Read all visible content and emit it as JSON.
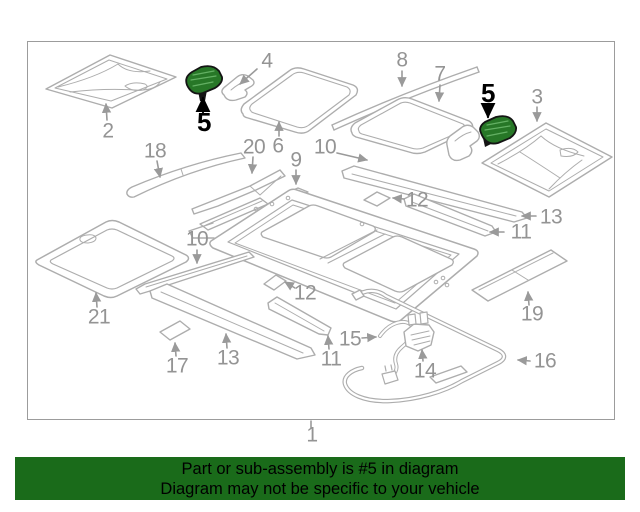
{
  "banner": {
    "line1": "Part or sub-assembly is #5 in diagram",
    "line2": "Diagram may not be specific to your vehicle",
    "bg_color": "#1a6b1a",
    "text_color": "#000000"
  },
  "diagram": {
    "border_color": "#9c9c9c",
    "line_color": "#adadad",
    "label_color": "#949494",
    "arrow_color": "#9a9a9a",
    "highlight_fill": "#277727",
    "highlight_rib_color": "#63b063",
    "highlight_outline": "#141414",
    "highlight_label_color": "#000000",
    "highlighted_part_number": "5",
    "callouts": [
      {
        "id": "2",
        "label": "2",
        "x": 108,
        "y": 131,
        "highlighted": false,
        "arrow": {
          "x1": 107,
          "y1": 120,
          "x2": 106,
          "y2": 104
        }
      },
      {
        "id": "5-left",
        "label": "5",
        "x": 204,
        "y": 122,
        "highlighted": true,
        "arrow": {
          "x1": 203,
          "y1": 112,
          "x2": 203,
          "y2": 98
        }
      },
      {
        "id": "4-left",
        "label": "4",
        "x": 267,
        "y": 61,
        "highlighted": false,
        "arrow": {
          "x1": 257,
          "y1": 69,
          "x2": 240,
          "y2": 84
        }
      },
      {
        "id": "6",
        "label": "6",
        "x": 278,
        "y": 146,
        "highlighted": false,
        "arrow": {
          "x1": 279,
          "y1": 136,
          "x2": 279,
          "y2": 122
        }
      },
      {
        "id": "8",
        "label": "8",
        "x": 402,
        "y": 60,
        "highlighted": false,
        "arrow": {
          "x1": 402,
          "y1": 71,
          "x2": 402,
          "y2": 86
        }
      },
      {
        "id": "7",
        "label": "7",
        "x": 440,
        "y": 74,
        "highlighted": false,
        "arrow": {
          "x1": 440,
          "y1": 85,
          "x2": 439,
          "y2": 101
        }
      },
      {
        "id": "5-right",
        "label": "5",
        "x": 488,
        "y": 93,
        "highlighted": true,
        "arrow": {
          "x1": 488,
          "y1": 104,
          "x2": 488,
          "y2": 117
        }
      },
      {
        "id": "3",
        "label": "3",
        "x": 537,
        "y": 97,
        "highlighted": false,
        "arrow": {
          "x1": 537,
          "y1": 107,
          "x2": 537,
          "y2": 121
        }
      },
      {
        "id": "18",
        "label": "18",
        "x": 155,
        "y": 151,
        "highlighted": false,
        "arrow": {
          "x1": 157,
          "y1": 161,
          "x2": 160,
          "y2": 177
        }
      },
      {
        "id": "20",
        "label": "20",
        "x": 254,
        "y": 147,
        "highlighted": false,
        "arrow": {
          "x1": 253,
          "y1": 157,
          "x2": 252,
          "y2": 173
        }
      },
      {
        "id": "9",
        "label": "9",
        "x": 296,
        "y": 160,
        "highlighted": false,
        "arrow": {
          "x1": 296,
          "y1": 170,
          "x2": 296,
          "y2": 184
        }
      },
      {
        "id": "10-top",
        "label": "10",
        "x": 325,
        "y": 147,
        "highlighted": false,
        "arrow": {
          "x1": 337,
          "y1": 153,
          "x2": 367,
          "y2": 160
        }
      },
      {
        "id": "12-right",
        "label": "12",
        "x": 417,
        "y": 200,
        "highlighted": false,
        "arrow": {
          "x1": 404,
          "y1": 199,
          "x2": 393,
          "y2": 198
        }
      },
      {
        "id": "13-right",
        "label": "13",
        "x": 551,
        "y": 217,
        "highlighted": false,
        "arrow": {
          "x1": 536,
          "y1": 216,
          "x2": 522,
          "y2": 216
        }
      },
      {
        "id": "11-right",
        "label": "11",
        "x": 521,
        "y": 232,
        "highlighted": false,
        "arrow": {
          "x1": 504,
          "y1": 232,
          "x2": 490,
          "y2": 232
        }
      },
      {
        "id": "10-left",
        "label": "10",
        "x": 197,
        "y": 239,
        "highlighted": false,
        "arrow": {
          "x1": 197,
          "y1": 250,
          "x2": 197,
          "y2": 263
        }
      },
      {
        "id": "12-left",
        "label": "12",
        "x": 305,
        "y": 293,
        "highlighted": false,
        "arrow": {
          "x1": 295,
          "y1": 288,
          "x2": 285,
          "y2": 282
        }
      },
      {
        "id": "21",
        "label": "21",
        "x": 99,
        "y": 317,
        "highlighted": false,
        "arrow": {
          "x1": 97,
          "y1": 307,
          "x2": 96,
          "y2": 293
        }
      },
      {
        "id": "17",
        "label": "17",
        "x": 177,
        "y": 366,
        "highlighted": false,
        "arrow": {
          "x1": 176,
          "y1": 356,
          "x2": 175,
          "y2": 343
        }
      },
      {
        "id": "13-left",
        "label": "13",
        "x": 228,
        "y": 358,
        "highlighted": false,
        "arrow": {
          "x1": 227,
          "y1": 348,
          "x2": 226,
          "y2": 334
        }
      },
      {
        "id": "11-left",
        "label": "11",
        "x": 331,
        "y": 359,
        "highlighted": false,
        "arrow": {
          "x1": 329,
          "y1": 349,
          "x2": 328,
          "y2": 336
        }
      },
      {
        "id": "15",
        "label": "15",
        "x": 350,
        "y": 339,
        "highlighted": false,
        "arrow": {
          "x1": 362,
          "y1": 338,
          "x2": 376,
          "y2": 337
        }
      },
      {
        "id": "14",
        "label": "14",
        "x": 425,
        "y": 371,
        "highlighted": false,
        "arrow": {
          "x1": 423,
          "y1": 361,
          "x2": 422,
          "y2": 350
        }
      },
      {
        "id": "16",
        "label": "16",
        "x": 545,
        "y": 361,
        "highlighted": false,
        "arrow": {
          "x1": 530,
          "y1": 361,
          "x2": 518,
          "y2": 360
        }
      },
      {
        "id": "19",
        "label": "19",
        "x": 532,
        "y": 314,
        "highlighted": false,
        "arrow": {
          "x1": 529,
          "y1": 305,
          "x2": 528,
          "y2": 292
        }
      },
      {
        "id": "1",
        "label": "1",
        "x": 312,
        "y": 435,
        "highlighted": false,
        "head": false,
        "arrow": {
          "x1": 311,
          "y1": 428,
          "x2": 311,
          "y2": 421
        }
      }
    ]
  }
}
